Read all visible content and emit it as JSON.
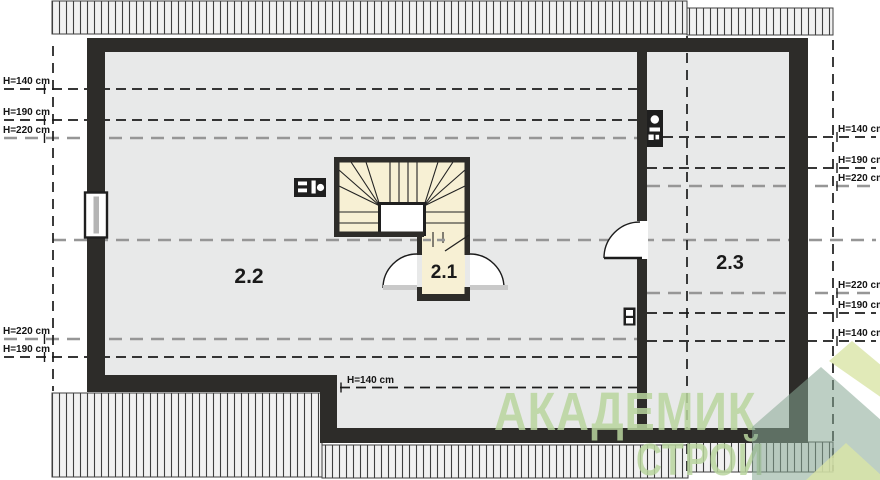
{
  "plan": {
    "rooms": [
      {
        "label": "2.2"
      },
      {
        "label": "2.1"
      },
      {
        "label": "2.3"
      }
    ],
    "height_labels_left": [
      "H=140 cm",
      "H=190 cm",
      "H=220 cm",
      "H=220 cm",
      "H=190 cm"
    ],
    "height_labels_right": [
      "H=140 cm",
      "H=190 cm",
      "H=220 cm",
      "H=220 cm",
      "H=190 cm",
      "H=140 cm"
    ],
    "height_label_inline": "H=140 cm",
    "heights_cm": [
      140,
      190,
      220
    ],
    "icons": [
      {
        "name": "flue-stack-icon"
      },
      {
        "name": "flue-vent-icon"
      },
      {
        "name": "vent-box-icon"
      },
      {
        "name": "window-icon"
      },
      {
        "name": "door-swing-icon"
      },
      {
        "name": "stair-run-icon"
      },
      {
        "name": "house-logo-icon"
      }
    ]
  },
  "watermark": {
    "line1": "АКАДЕМИК",
    "line2": "СТРОЙ"
  },
  "colors": {
    "wall": "#2d2c29",
    "floor": "#e8e9e9",
    "stair_fill": "#f7f0d4",
    "dash_black": "#1b1b1b",
    "dash_gray": "#969696",
    "hatch_fill": "#f1f1f1",
    "threshold_gray": "#c9c9c9",
    "watermark_text_green": "#b8d59e",
    "watermark_sage": "#87a794",
    "watermark_pale": "#d9e5a6"
  }
}
